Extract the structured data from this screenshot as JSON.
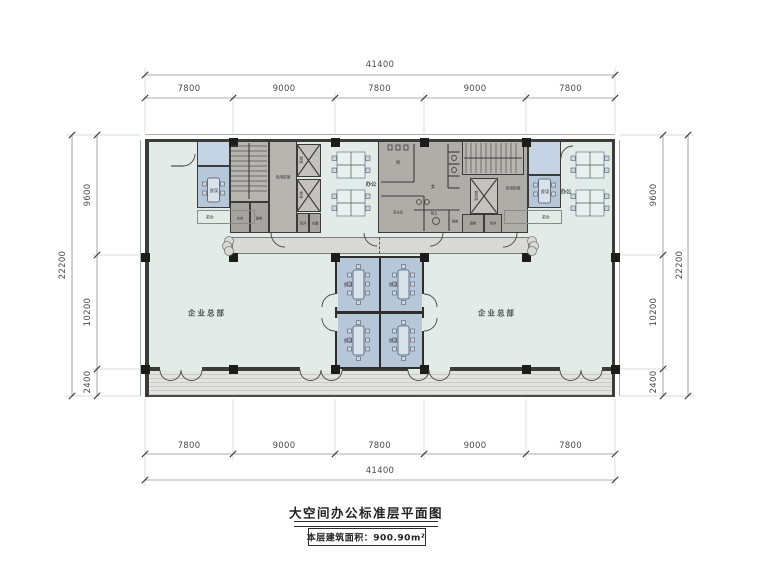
{
  "title": {
    "name": "大空间办公标准层平面图",
    "area": "本层建筑面积：900.90m²"
  },
  "dims": {
    "top": {
      "total": "41400",
      "segments": [
        "7800",
        "9000",
        "7800",
        "9000",
        "7800"
      ]
    },
    "bottom": {
      "total": "41400",
      "segments": [
        "7800",
        "9000",
        "7800",
        "9000",
        "7800"
      ]
    },
    "left": {
      "total": "22200",
      "segments": [
        "9600",
        "10200",
        "2400"
      ]
    },
    "right": {
      "total": "22200",
      "segments": [
        "9600",
        "10200",
        "2400"
      ]
    }
  },
  "plan": {
    "hq": "企业总部",
    "office": "办公",
    "meeting": "会议",
    "reception": "前台",
    "meeting_rooms": [
      "会议",
      "会议",
      "会议",
      "会议"
    ],
    "core": {
      "lobby": "合用前室",
      "elevator": "客梯",
      "fire_elevator": "消防梯",
      "men": "男",
      "women": "女",
      "pantry": "茶水间",
      "accessible_wc": "残卫",
      "water_shaft": "水井",
      "power": "强电",
      "air_shaft": "风井",
      "plumbing": "水暖",
      "low_voltage": "弱电"
    }
  },
  "colors": {
    "open": "#e2ebe7",
    "meet": "#b7c7da",
    "meetlight": "#c5d4e5",
    "core": "#aeada8",
    "corelight": "#b6b5b0",
    "shaft": "#a5a49f",
    "lift": "#c3c2bd",
    "canopy": "#d9d9d5",
    "balcony": "#e3e3df",
    "wall": "#3b3b3a"
  }
}
